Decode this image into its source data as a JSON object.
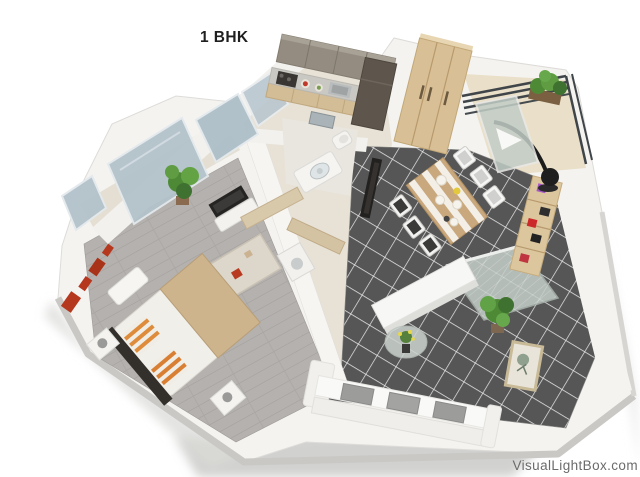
{
  "title": "1 BHK",
  "watermark": {
    "label": "VisualLightBox.com"
  },
  "palette": {
    "background": "#ffffff",
    "title_text": "#1f1f1f",
    "watermark_text": "#6b6b6b",
    "tile_floor": "#565656",
    "tile_grout": "#e9e9e9",
    "wood_floor": "#b4b1ae",
    "wall_white": "#f4f3f0",
    "wall_shadow": "#c9c8c5",
    "glass_blue": "#b3c2cb",
    "furniture_wood": "#d8bf96",
    "accent_red": "#b5371e",
    "pillow_orange": "#de8c3c",
    "plant_green": "#4e8a36",
    "dark_fixture": "#332f2b"
  }
}
